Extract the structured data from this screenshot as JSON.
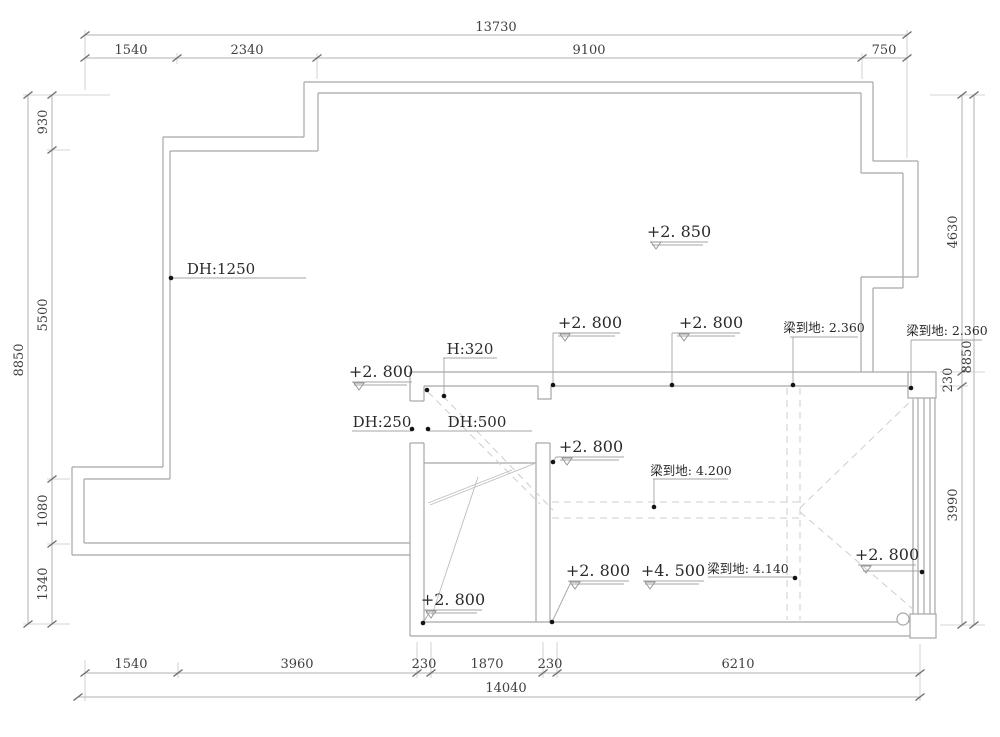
{
  "drawing": {
    "kind": "ceiling-elevation-floor-plan",
    "colors": {
      "wall": "#a7a7a7",
      "dimension_text": "#3f3f3f",
      "label_text": "#2a2a2a",
      "dashed_beam": "#cdcdcd"
    },
    "dims": {
      "top": {
        "overall": "13730",
        "segments": [
          "1540",
          "2340",
          "9100",
          "750"
        ]
      },
      "bottom": {
        "overall": "14040",
        "segments": [
          "1540",
          "3960",
          "230",
          "1870",
          "230",
          "6210"
        ]
      },
      "left": {
        "overall": "8850",
        "segments": [
          "930",
          "5500",
          "1080",
          "1340"
        ]
      },
      "right": {
        "overall": "8850",
        "segments": [
          "4630",
          "230",
          "3990"
        ]
      }
    },
    "ann": {
      "elev_2850": "+2. 850",
      "elev_2800": "+2. 800",
      "elev_4500": "+4. 500",
      "dh_1250": "DH:1250",
      "dh_250": "DH:250",
      "dh_500": "DH:500",
      "h_320": "H:320",
      "beam_2360": "梁到地: 2.360",
      "beam_4200": "梁到地: 4.200",
      "beam_4140": "梁到地: 4.140"
    }
  }
}
